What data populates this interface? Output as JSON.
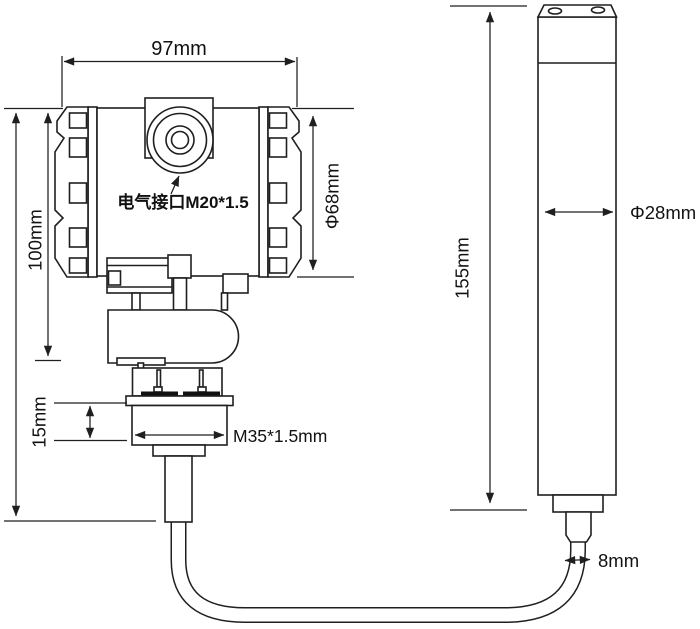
{
  "diagram": {
    "transmitter": {
      "width_label": "97mm",
      "height_label": "100mm",
      "diameter_label": "Φ68mm",
      "electrical_interface_label": "电气接口M20*1.5",
      "flange_height_label": "15mm",
      "thread_label": "M35*1.5mm"
    },
    "probe": {
      "length_label": "155mm",
      "diameter_label": "Φ28mm",
      "cable_diameter_label": "8mm"
    },
    "colors": {
      "line": "#1f1f1f",
      "background": "#ffffff",
      "text": "#111111"
    }
  }
}
